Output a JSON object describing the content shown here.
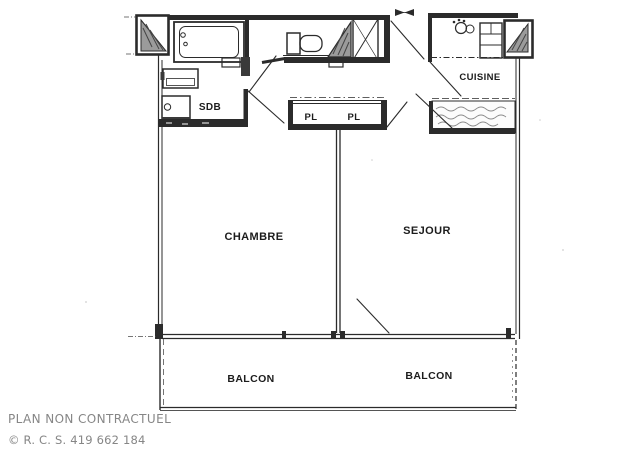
{
  "plan": {
    "rooms": [
      {
        "id": "sdb",
        "label": "SDB"
      },
      {
        "id": "pl-left",
        "label": "PL"
      },
      {
        "id": "pl-right",
        "label": "PL"
      },
      {
        "id": "cuisine",
        "label": "CUISINE"
      },
      {
        "id": "chambre",
        "label": "CHAMBRE"
      },
      {
        "id": "sejour",
        "label": "SEJOUR"
      },
      {
        "id": "balcon-left",
        "label": "BALCON"
      },
      {
        "id": "balcon-right",
        "label": "BALCON"
      }
    ],
    "footer": {
      "disclaimer": "PLAN NON CONTRACTUEL",
      "registration": "© R. C. S. 419 662 184"
    },
    "colors": {
      "ink": "#262626",
      "hatch_fill": "#9b9b9b",
      "muted_text": "#868686",
      "paper": "#ffffff"
    }
  }
}
